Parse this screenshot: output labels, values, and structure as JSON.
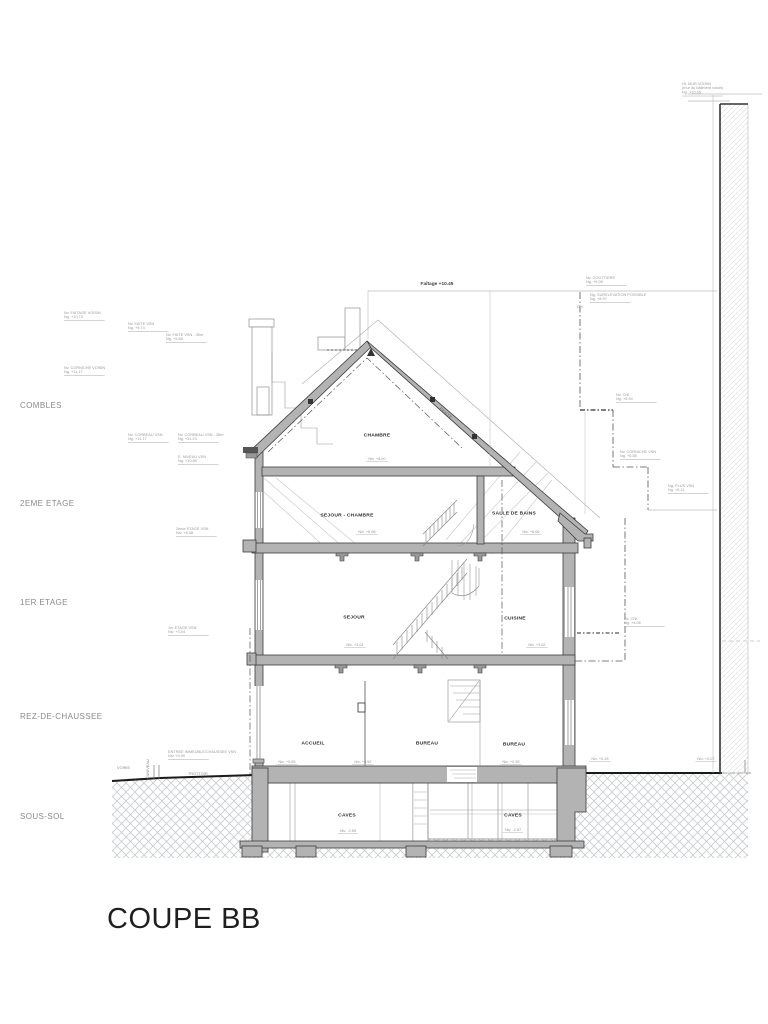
{
  "title": "COUPE BB",
  "floors": {
    "combles": "COMBLES",
    "deuxieme_etage": "2EME ETAGE",
    "premier_etage": "1ER ETAGE",
    "rez_de_chaussee": "REZ-DE-CHAUSSEE",
    "sous_sol": "SOUS-SOL"
  },
  "street": {
    "voirie": "VOIRIE",
    "caniveau": "CANIVEAU",
    "trottoir": "TROTTOIR"
  },
  "roof": {
    "ridge_level": "Faîtage +10.45",
    "slope": "PENTE",
    "ch": "CH"
  },
  "rooms": {
    "attic": {
      "name": "CHAMBRE",
      "level": "Niv. +8.00"
    },
    "second_left": {
      "name": "SEJOUR - CHAMBRE",
      "level": "Niv. +6.08"
    },
    "second_right": {
      "name": "SALLE DE BAINS",
      "level": "Niv. +6.06"
    },
    "first_left": {
      "name": "SEJOUR",
      "level": "Niv. +3.04"
    },
    "first_right": {
      "name": "CUISINE",
      "level": "Niv. +3.02"
    },
    "ground_left": {
      "name": "ACCUEIL",
      "level": "Niv. +0.55"
    },
    "ground_mid": {
      "name": "BUREAU",
      "level": "Niv. +0.52"
    },
    "ground_right": {
      "name": "BUREAU",
      "level": "Niv. +0.35"
    },
    "cave_left": {
      "name": "CAVES",
      "level": "Niv. -2.55"
    },
    "cave_right": {
      "name": "CAVES",
      "level": "Niv. -2.57"
    }
  },
  "site_levels": {
    "court_left": "Niv. +0.15",
    "court_right": "Niv. +0.07"
  },
  "annotations": [
    {
      "l1": "Nv. FAITAGE VOISIN",
      "l2": "Ng. +10.73"
    },
    {
      "l1": "Nv. FAITE VSN",
      "l2": "Ng. +9.74"
    },
    {
      "l1": "Nv. FAITE VSN - 35m",
      "l2": "Ng. +9.88"
    },
    {
      "l1": "Nv. CORNICHE VOISIN",
      "l2": "Ng. +11.17"
    },
    {
      "l1": "Nv. CORBEAU VSN",
      "l2": "Ng. +11.17"
    },
    {
      "l1": "Nv. CORBEAU VSN - 35m",
      "l2": "Ng. +11.23"
    },
    {
      "l1": "E. NIVEAU VSN",
      "l2": "Ng. +10.80"
    },
    {
      "l1": "2eme ETAGE VSN",
      "l2": "Niv. +6.08"
    },
    {
      "l1": "1er ETAGE VSN",
      "l2": "Niv. +3.04"
    },
    {
      "l1": "ENTREE IMMEUBLE/CHAUSSEE VSN",
      "l2": "Niv. +0.00"
    },
    {
      "l1": "Nv. GOUTTIERE",
      "l2": "Ng. +9.08"
    },
    {
      "l1": "Ng. SURELEVATION POSSIBLE",
      "l2": "Ng. +8.97"
    },
    {
      "l1": "Nv. CNI",
      "l2": "Ng. +6.94"
    },
    {
      "l1": "Nv. CORNICHE VSN",
      "l2": "Ng. +6.55"
    },
    {
      "l1": "Ng. PLUS VSN",
      "l2": "Ng. +5.11"
    },
    {
      "l1": "Nv. CNI",
      "l2": "Ng. +4.06"
    },
    {
      "l1": "Ht. MUR VOISIN",
      "l2": "(mur du bâtiment voisin)",
      "l3": "Ng. +10.95"
    }
  ]
}
